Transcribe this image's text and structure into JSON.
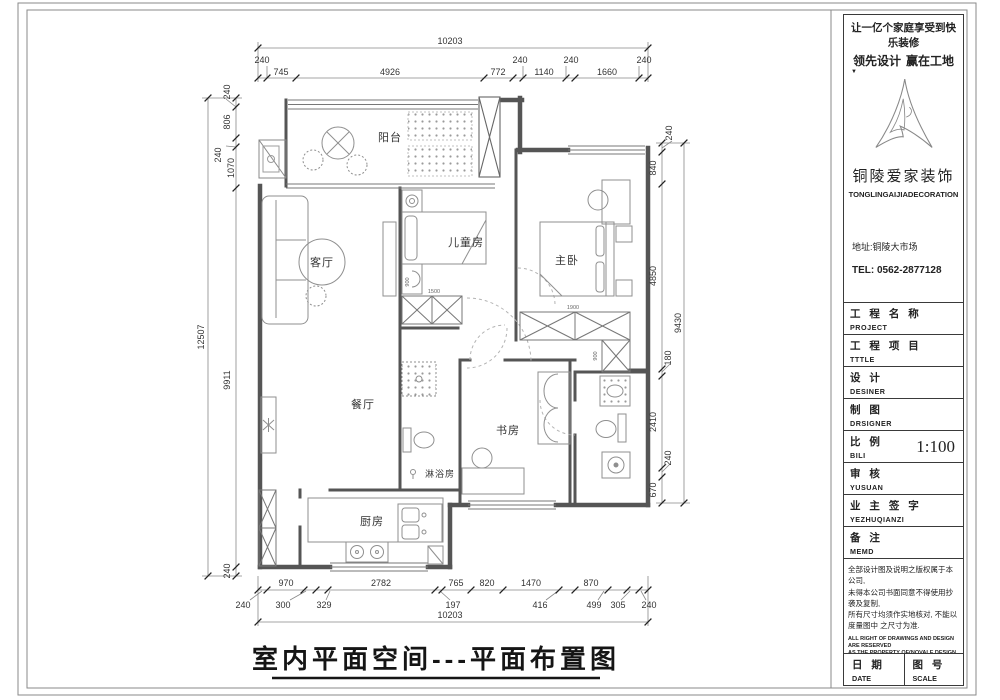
{
  "sheet": {
    "drawing_title": "室内平面空间---平面布置图"
  },
  "company": {
    "slogan_line1": "让一亿个家庭享受到快乐装修",
    "slogan_left": "领先设计",
    "slogan_right": "赢在工地",
    "marker": "▼",
    "name_cn": "铜陵爱家装饰",
    "name_en": "TONGLINGAIJIADECORATION",
    "address": "地址:铜陵大市场",
    "tel": "TEL:  0562-2877128"
  },
  "titleblock": {
    "fields": [
      {
        "cn": "工 程 名 称",
        "en": "PROJECT",
        "value": ""
      },
      {
        "cn": "工 程 项 目",
        "en": "TTTLE",
        "value": ""
      },
      {
        "cn": "设  计",
        "en": "DESINER",
        "value": ""
      },
      {
        "cn": "制  图",
        "en": "DRSIGNER",
        "value": ""
      },
      {
        "cn": "比  例",
        "en": "BILI",
        "value": "1:100"
      },
      {
        "cn": "审  核",
        "en": "YUSUAN",
        "value": ""
      },
      {
        "cn": "业 主 签 字",
        "en": "YEZHUQIANZI",
        "value": ""
      },
      {
        "cn": "备  注",
        "en": "MEMD",
        "value": ""
      }
    ],
    "notes_cn": [
      "全部设计图及说明之版权属于本公司,",
      "未得本公司书面同意不得使用抄袭及复制,",
      "所有尺寸均须作实地核对, 不能以",
      "度量图中 之尺寸为准."
    ],
    "notes_en": [
      "ALL RIGHT OF DRAWINGS AND DESIGN ARE RESERVED",
      "AS THE PROPERTY OF(NOVALE DESIGN & CONSTRUCTIO",
      "COMPANY.",
      "DO NOT SCALE DRAWINGS ALL MEASUREMENTS",
      "MUST BE CHECKED ON SITE."
    ],
    "footer": {
      "date_cn": "日 期",
      "date_en": "DATE",
      "no_cn": "图 号",
      "no_en": "SCALE"
    }
  },
  "rooms": {
    "balcony": "阳台",
    "living": "客厅",
    "children": "儿童房",
    "master": "主卧",
    "dining": "餐厅",
    "study": "书房",
    "shower": "淋浴房",
    "kitchen": "厨房"
  },
  "dims": {
    "top_total": "10203",
    "top_chain": [
      "240",
      "745",
      "4926",
      "772",
      "240",
      "1140",
      "240",
      "1660",
      "240"
    ],
    "bottom_total": "10203",
    "bottom_tier1": [
      "970",
      "2782",
      "765",
      "820",
      "1470",
      "870"
    ],
    "bottom_tier2": [
      "240",
      "300",
      "329",
      "197",
      "416",
      "499",
      "305",
      "240"
    ],
    "left_total": "12507",
    "left_chain": [
      "240",
      "806",
      "240",
      "1070",
      "9911",
      "240"
    ],
    "right_total": "9430",
    "right_chain": [
      "240",
      "840",
      "4850",
      "180",
      "2410",
      "240",
      "670"
    ]
  },
  "interior_dims": {
    "children_width": "1500",
    "children_depth": "900",
    "master_width": "1900",
    "master_depth": "900"
  },
  "colors": {
    "ink": "#3a3a3a",
    "wall": "#555555",
    "furniture": "#8f8f8f",
    "dimline": "#777777"
  }
}
